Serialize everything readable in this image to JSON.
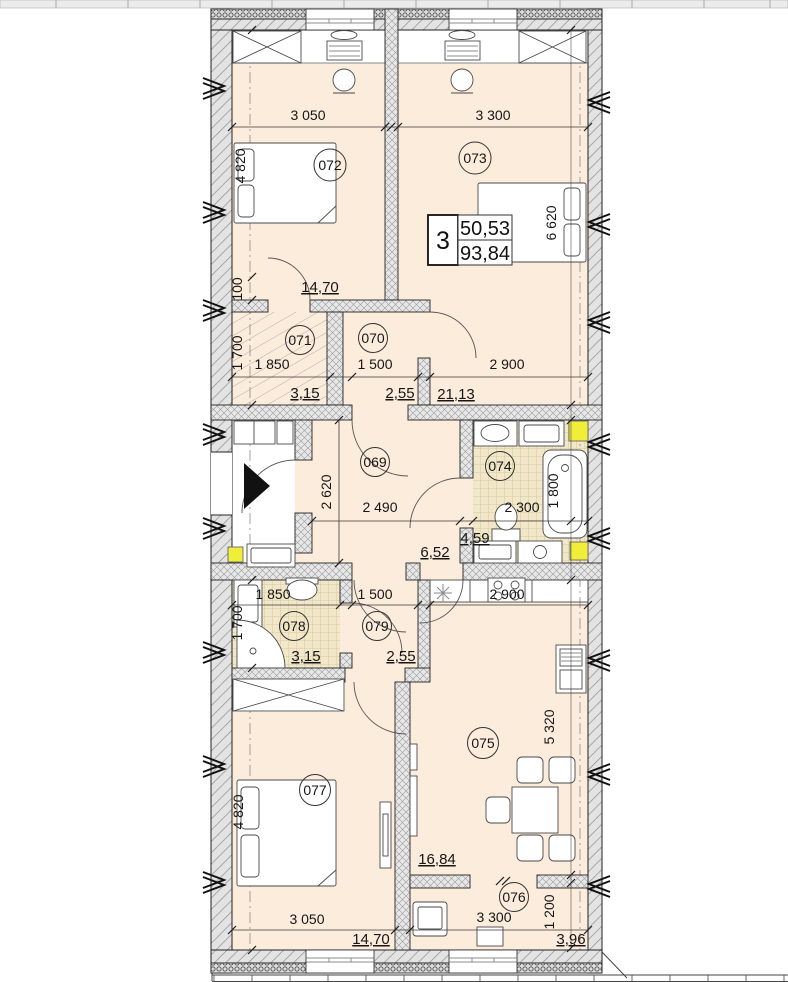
{
  "summary_box": {
    "rooms_count": "3",
    "area_living": "50,53",
    "area_total": "93,84"
  },
  "rooms": {
    "r069": {
      "number": "069",
      "area": "6,52",
      "dim_w": "2 490",
      "dim_h": "2 620"
    },
    "r070": {
      "number": "070",
      "area": "2,55",
      "dim_w": "1 500"
    },
    "r071": {
      "number": "071",
      "area": "3,15",
      "dim_w": "1 850",
      "dim_h": "1 700"
    },
    "r072": {
      "number": "072",
      "area": "14,70",
      "dim_w": "3 050",
      "dim_h": "4 820"
    },
    "r073": {
      "number": "073",
      "area": "21,13",
      "dim_w": "3 300",
      "dim_h": "6 620",
      "dim_w2": "2 900"
    },
    "r074": {
      "number": "074",
      "area": "4,59",
      "dim_w": "2 300",
      "dim_h": "1 800"
    },
    "r075": {
      "number": "075",
      "area": "16,84",
      "dim_w": "2 900",
      "dim_h": "5 320"
    },
    "r076": {
      "number": "076",
      "area": "3,96",
      "dim_w": "3 300",
      "dim_h": "1 200"
    },
    "r077": {
      "number": "077",
      "area": "14,70",
      "dim_w": "3 050",
      "dim_h": "4 820"
    },
    "r078": {
      "number": "078",
      "area": "3,15",
      "dim_w": "1 850",
      "dim_h": "1 700"
    },
    "r079": {
      "number": "079",
      "area": "2,55",
      "dim_w": "1 500"
    }
  },
  "extra_dims": {
    "left_small": "100"
  },
  "colors": {
    "floor_peach": "#fcecdc",
    "tile_beige": "#f2e8c9",
    "shaft_yellow": "#f1ee39",
    "wall_gray": "#e3e3e3",
    "line_dark": "#1c1c1c"
  }
}
